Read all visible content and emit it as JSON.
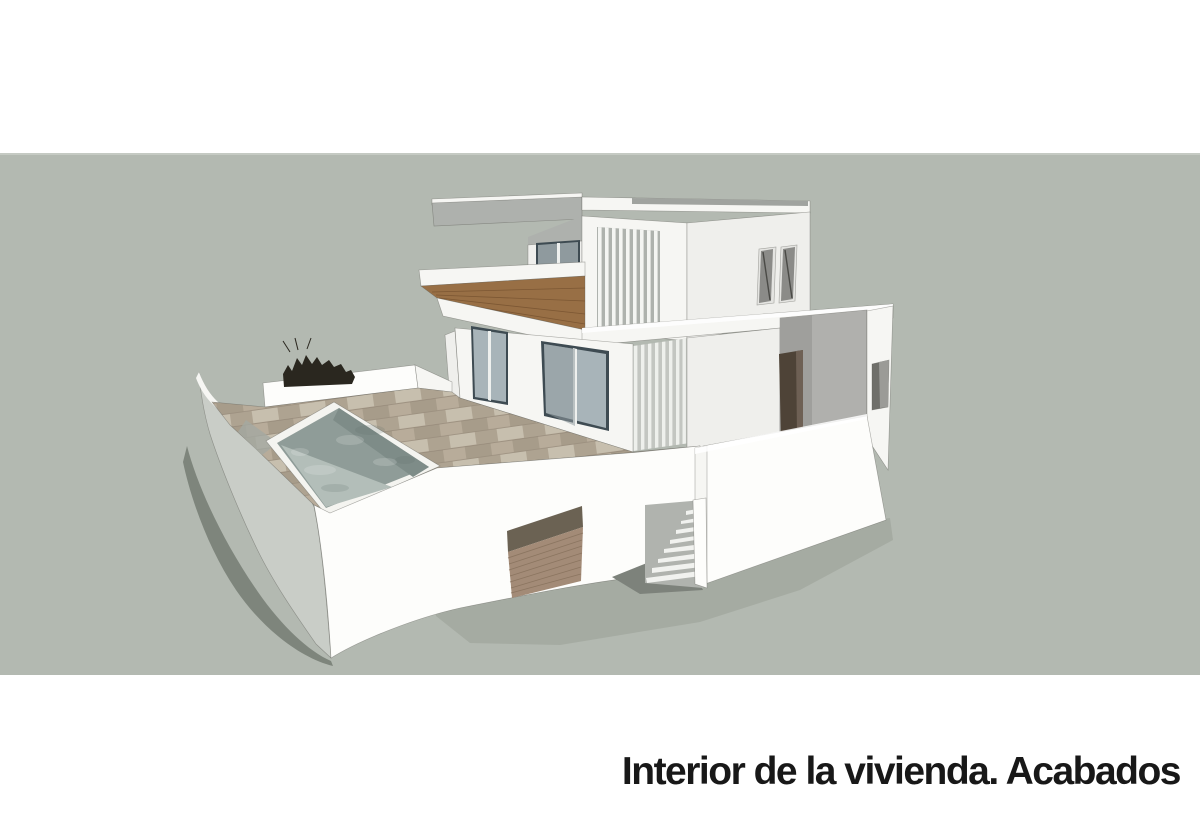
{
  "caption": {
    "text": "Interior de la vivienda. Acabados"
  },
  "scene": {
    "description": "SketchUp-style 3D rendering of a two-storey white modern villa with cantilevered roof canopy, vertical louver screens, wood deck balcony, sliding glass doors, tiled patio with swimming pool, curved perimeter wall, garage roller door, external staircase and entrance courtyard, casting shadows on grey-green ground",
    "objects": [
      "canopy-roof-slab",
      "upper-floor-volume",
      "louver-screen-upper",
      "balcony-glass-door",
      "facade-windows",
      "wood-deck-terrace",
      "sliding-glass-doors",
      "louver-screen-lower",
      "tiled-patio",
      "swimming-pool",
      "curved-perimeter-wall",
      "planter-bush",
      "garage-roller-door",
      "external-staircase",
      "entrance-courtyard",
      "ground-shadows"
    ]
  },
  "colors": {
    "pageBackground": "#ffffff",
    "band": "#b3b9b1",
    "bandTopLine": "#cdd2cb",
    "wallBright": "#fdfdfb",
    "wallLight": "#f6f6f3",
    "wallMid": "#efefec",
    "wallShaded": "#c9cdc7",
    "soffitGray": "#aeb1ad",
    "roofSliver": "#a0a39f",
    "recessGray": "#b0b0ad",
    "recessDark": "#9f9f9c",
    "louverGap": "#aeb2ad",
    "louverGapLower": "#c3c6c1",
    "louverSlat": "#f4f5f2",
    "glass": "#a8b4b9",
    "glassDark": "#8f9a9e",
    "frame": "#3e4b52",
    "deck": "#986f45",
    "deckLine": "#7c5733",
    "tileBase": "#b8ac9a",
    "tileLight": "#c7bfae",
    "tileDark": "#a79c8a",
    "tileJoint": "#8f8473",
    "poolWall": "#8f9c98",
    "poolWallDark": "#7e8c88",
    "poolFloor": "#b3beb9",
    "coping": "#f4f4f0",
    "garageDoor": "#a38b77",
    "garageBand": "#6b6253",
    "garageLine": "#8b7560",
    "doorDark": "#4e4337",
    "bush": "#2a271f",
    "shadowCast": "#7e857c",
    "shadowGround": "#a4a9a1",
    "shadowStair": "#7d827b",
    "stairGray": "#b0b3ae",
    "captionColor": "#181818"
  }
}
